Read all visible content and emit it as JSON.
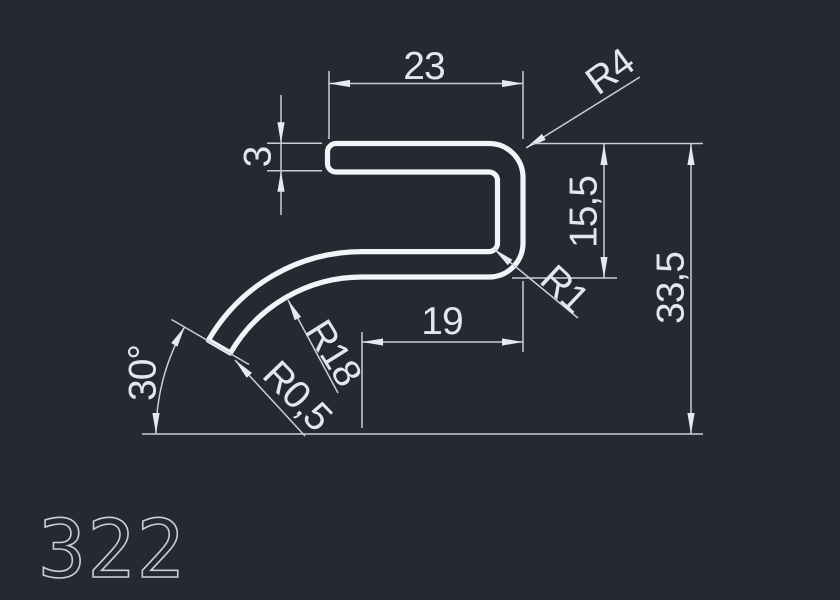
{
  "drawing": {
    "part_number": "322",
    "colors": {
      "background": "#242932",
      "geometry": "#f2f5f8",
      "dimension_lines": "#c9cfd7",
      "text": "#e3e7ec"
    },
    "dimensions": {
      "top_width": "23",
      "wall_thickness": "3",
      "outer_radius": "R4",
      "upper_height": "15,5",
      "inner_radius": "R1",
      "total_height": "33,5",
      "lower_width": "19",
      "bend_radius": "R18",
      "tip_radius": "R0,5",
      "end_angle": "30°"
    }
  }
}
